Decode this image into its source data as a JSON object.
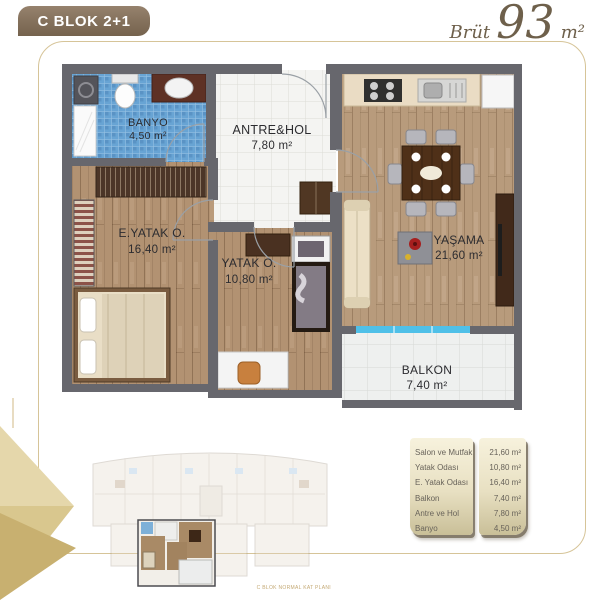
{
  "header": {
    "badge": "C BLOK 2+1",
    "brut_label": "Brüt",
    "brut_value": "93",
    "brut_unit": "m²"
  },
  "floorplan": {
    "rooms": [
      {
        "id": "banyo",
        "name": "BANYO",
        "area": "4,50 m²"
      },
      {
        "id": "antre",
        "name": "ANTRE&HOL",
        "area": "7,80 m²"
      },
      {
        "id": "eyatak",
        "name": "E.YATAK O.",
        "area": "16,40 m²"
      },
      {
        "id": "yatak",
        "name": "YATAK O.",
        "area": "10,80 m²"
      },
      {
        "id": "yasama",
        "name": "YAŞAMA",
        "area": "21,60 m²"
      },
      {
        "id": "balkon",
        "name": "BALKON",
        "area": "7,40 m²"
      }
    ]
  },
  "keyplan": {
    "caption": "C BLOK NORMAL KAT PLANI"
  },
  "table": {
    "rows": [
      {
        "label": "Salon ve Mutfak",
        "value": "21,60 m²"
      },
      {
        "label": "Yatak Odası",
        "value": "10,80 m²"
      },
      {
        "label": "E. Yatak Odası",
        "value": "16,40 m²"
      },
      {
        "label": "Balkon",
        "value": "7,40 m²"
      },
      {
        "label": "Antre ve Hol",
        "value": "7,80 m²"
      },
      {
        "label": "Banyo",
        "value": "4,50 m²"
      }
    ]
  },
  "colors": {
    "badge_brown": "#8a7662",
    "gold_border": "#d6c498",
    "gold_motif": "#d3bd85",
    "wall_gray": "#67676d",
    "wood": "#b29272",
    "bath_blue": "#68a4d4",
    "glass_blue": "#4fc0e8"
  }
}
